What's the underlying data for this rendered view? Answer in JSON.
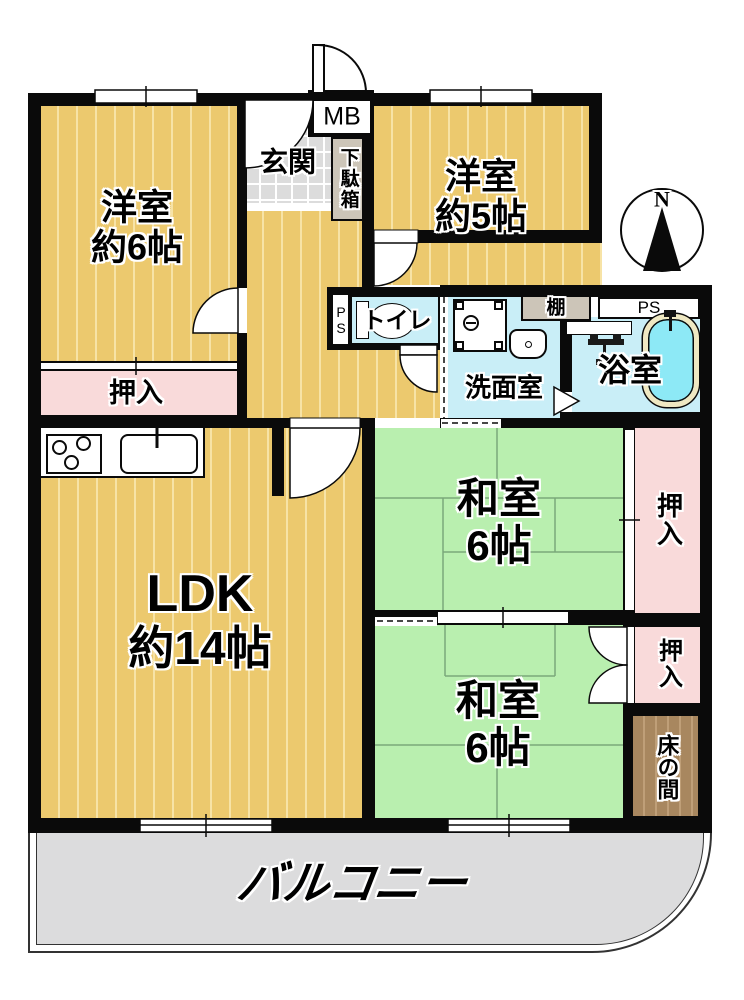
{
  "floorplan": {
    "compass": {
      "north": "N"
    },
    "labels": {
      "west_room_1_name": "洋室",
      "west_room_1_size": "約6帖",
      "west_room_2_name": "洋室",
      "west_room_2_size": "約5帖",
      "ldk_name": "LDK",
      "ldk_size": "約14帖",
      "jp_room_1_name": "和室",
      "jp_room_1_size": "6帖",
      "jp_room_2_name": "和室",
      "jp_room_2_size": "6帖",
      "entrance": "玄関",
      "shoe_box": "下駄箱",
      "meter_box": "MB",
      "pipe_space_toilet": "PS",
      "pipe_space_bath": "PS",
      "toilet": "トイレ",
      "washroom": "洗面室",
      "bathroom": "浴室",
      "shelf": "棚",
      "closet_west": "押入",
      "closet_east_upper": "押入",
      "closet_east_lower": "押入",
      "tokonoma": "床の間",
      "balcony": "バルコニー"
    },
    "colors": {
      "wall": "#0a0a0a",
      "wood_floor": "#ecc96e",
      "wood_floor_stripe": "#f7e3a6",
      "tatami_green": "#b9efaf",
      "tatami_line": "#7aa87a",
      "closet_pink": "#f9dada",
      "wet_area_blue": "#c9eef7",
      "bathtub_water": "#8de9f6",
      "bathtub_rim": "#efe8c2",
      "entrance_tile": "#dcdcdc",
      "cabinet_tan": "#ccc5b8",
      "tokonoma_brown": "#a8875f",
      "balcony_gray": "#dcdcdd"
    }
  }
}
